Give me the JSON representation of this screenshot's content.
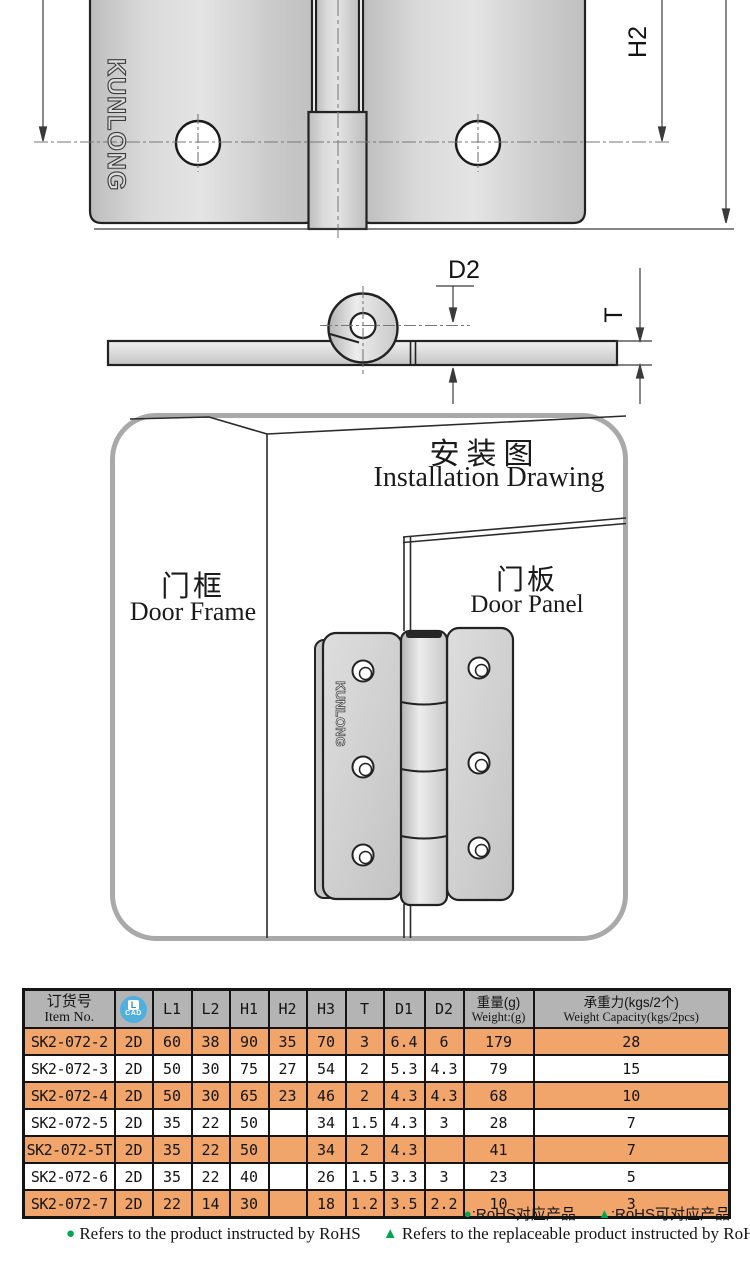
{
  "brand": {
    "logo_text": "KUNLONG"
  },
  "drawings": {
    "front_view_label_h2": "H2",
    "side_view_label_d2": "D2",
    "side_view_label_t": "T"
  },
  "installation": {
    "title_zh": "安装图",
    "title_en": "Installation Drawing",
    "door_frame_zh": "门框",
    "door_frame_en": "Door Frame",
    "door_panel_zh": "门板",
    "door_panel_en": "Door Panel",
    "hinge_logo": "KUNLONG"
  },
  "table": {
    "header": {
      "item_zh": "订货号",
      "item_en": "Item No.",
      "cad_letter": "L",
      "cad_word": "CAD",
      "dims": [
        "L1",
        "L2",
        "H1",
        "H2",
        "H3",
        "T",
        "D1",
        "D2"
      ],
      "weight_zh": "重量(g)",
      "weight_en": "Weight:(g)",
      "capacity_zh": "承重力(kgs/2个)",
      "capacity_en": "Weight Capacity(kgs/2pcs)"
    },
    "rows": [
      {
        "item": "SK2-072-2",
        "cad": "2D",
        "l1": "60",
        "l2": "38",
        "h1": "90",
        "h2": "35",
        "h3": "70",
        "t": "3",
        "d1": "6.4",
        "d2": "6",
        "weight": "179",
        "capacity": "28",
        "highlight": true
      },
      {
        "item": "SK2-072-3",
        "cad": "2D",
        "l1": "50",
        "l2": "30",
        "h1": "75",
        "h2": "27",
        "h3": "54",
        "t": "2",
        "d1": "5.3",
        "d2": "4.3",
        "weight": "79",
        "capacity": "15",
        "highlight": false
      },
      {
        "item": "SK2-072-4",
        "cad": "2D",
        "l1": "50",
        "l2": "30",
        "h1": "65",
        "h2": "23",
        "h3": "46",
        "t": "2",
        "d1": "4.3",
        "d2": "4.3",
        "weight": "68",
        "capacity": "10",
        "highlight": true
      },
      {
        "item": "SK2-072-5",
        "cad": "2D",
        "l1": "35",
        "l2": "22",
        "h1": "50",
        "h2": "/",
        "h3": "34",
        "t": "1.5",
        "d1": "4.3",
        "d2": "3",
        "weight": "28",
        "capacity": "7",
        "highlight": false
      },
      {
        "item": "SK2-072-5T",
        "cad": "2D",
        "l1": "35",
        "l2": "22",
        "h1": "50",
        "h2": "/",
        "h3": "34",
        "t": "2",
        "d1": "4.3",
        "d2": "/",
        "weight": "41",
        "capacity": "7",
        "highlight": true
      },
      {
        "item": "SK2-072-6",
        "cad": "2D",
        "l1": "35",
        "l2": "22",
        "h1": "40",
        "h2": "/",
        "h3": "26",
        "t": "1.5",
        "d1": "3.3",
        "d2": "3",
        "weight": "23",
        "capacity": "5",
        "highlight": false
      },
      {
        "item": "SK2-072-7",
        "cad": "2D",
        "l1": "22",
        "l2": "14",
        "h1": "30",
        "h2": "/",
        "h3": "18",
        "t": "1.2",
        "d1": "3.5",
        "d2": "2.2",
        "weight": "10",
        "capacity": "3",
        "highlight": true
      }
    ],
    "colors": {
      "highlight": "#f1a56a",
      "header_bg": "#b4b4b4"
    }
  },
  "legend": {
    "dot_glyph": "●",
    "tri_glyph": "▲",
    "zh_dot_label": ":RoHS对应产品",
    "zh_tri_label": ":RoHS可对应产品",
    "en_dot_label": "Refers to the product instructed by RoHS",
    "en_tri_label": "Refers to the replaceable product instructed by RoHS",
    "marker_color": "#00a551"
  }
}
